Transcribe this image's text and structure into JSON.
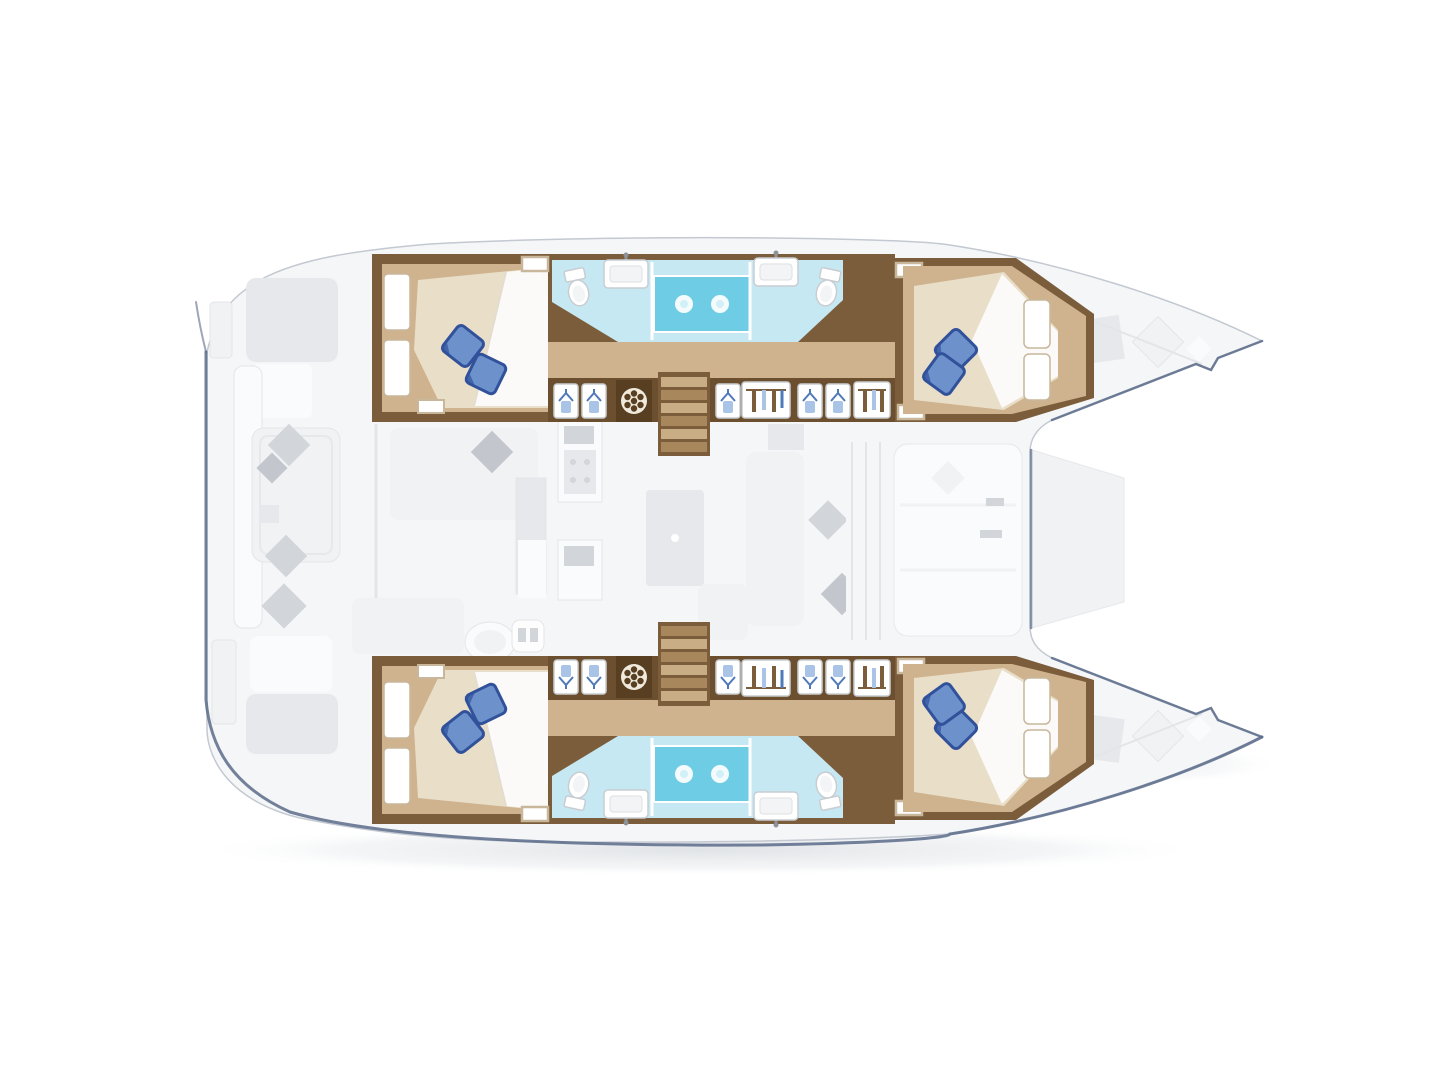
{
  "canvas": {
    "width": 1440,
    "height": 1080,
    "background": "#ffffff"
  },
  "colors": {
    "navy": "#5b6b89",
    "hull_line": "#c3c9d1",
    "deck_fill": "#f5f6f8",
    "deck_line": "#e3e5e9",
    "furn_light": "#f1f2f4",
    "furn_mid": "#e6e8eb",
    "furn_white": "#fafbfc",
    "cushion": "#d2d5da",
    "cushion_dark": "#c3c7cd",
    "wall_brown": "#7c5d3b",
    "wall_brown_deep": "#6c4f2f",
    "wall_brown_dark": "#583f22",
    "trim_tan": "#c8b79b",
    "floor_tan": "#cfb28e",
    "floor_tan_light": "#dcc9a8",
    "mattress_cream": "#e9dfc9",
    "duvet_white": "#fbfbf9",
    "pillow_blue": "#6d92cb",
    "pillow_blue_dark": "#31519b",
    "bath_floor": "#c5e8f3",
    "shower_blue": "#6ecde4",
    "shower_head_inner": "#d2f0f8",
    "fixture_line": "#c9cdd1",
    "fixture_fill": "#f2f4f5",
    "hanger_blue": "#4f79b8",
    "garment_blue": "#a9c4e6",
    "step_light": "#c9ad85",
    "step_dark": "#a8875c",
    "shadow_grey": "#dfe2e6"
  },
  "diagram": {
    "type": "catamaran-yacht-deck-plan",
    "style": "top-down-2d-floor-plan",
    "orientation": "bows-pointing-right",
    "decks": [
      {
        "name": "hull-accommodation-deck",
        "emphasis": "full-color"
      },
      {
        "name": "main-deck",
        "emphasis": "faded-grey"
      }
    ],
    "hulls": [
      {
        "name": "port-hull",
        "position": "top",
        "rooms": [
          {
            "name": "aft-double-cabin",
            "features": [
              "island-bed",
              "two-blue-pillows",
              "white-duvet",
              "hull-windows"
            ]
          },
          {
            "name": "aft-head-compartment",
            "features": [
              "toilet",
              "sink-with-faucet"
            ]
          },
          {
            "name": "central-shower",
            "features": [
              "two-shower-heads",
              "glass-partitions"
            ]
          },
          {
            "name": "forward-head-compartment",
            "features": [
              "sink-with-faucet",
              "toilet"
            ]
          },
          {
            "name": "companionway",
            "features": [
              "wardrobe-doors",
              "hanging-lockers",
              "washing-machine",
              "stairs-to-saloon",
              "deck-hatches"
            ]
          },
          {
            "name": "forward-double-cabin",
            "features": [
              "island-bed",
              "two-blue-pillows",
              "white-duvet",
              "hull-windows"
            ]
          }
        ]
      },
      {
        "name": "starboard-hull",
        "position": "bottom",
        "mirror_of": "port-hull",
        "rooms": [
          {
            "name": "aft-double-cabin",
            "features": [
              "island-bed",
              "two-blue-pillows",
              "white-duvet",
              "hull-windows"
            ]
          },
          {
            "name": "aft-head-compartment",
            "features": [
              "toilet",
              "sink-with-faucet"
            ]
          },
          {
            "name": "central-shower",
            "features": [
              "two-shower-heads",
              "glass-partitions"
            ]
          },
          {
            "name": "forward-head-compartment",
            "features": [
              "sink-with-faucet",
              "toilet"
            ]
          },
          {
            "name": "companionway",
            "features": [
              "wardrobe-doors",
              "hanging-lockers",
              "washing-machine",
              "stairs-to-saloon",
              "deck-hatches"
            ]
          },
          {
            "name": "forward-double-cabin",
            "features": [
              "island-bed",
              "two-blue-pillows",
              "white-duvet",
              "hull-windows"
            ]
          }
        ]
      }
    ],
    "main_deck_areas": [
      {
        "name": "aft-cockpit",
        "features": [
          "bench-seating",
          "cockpit-table",
          "scatter-cushions",
          "transom-steps"
        ]
      },
      {
        "name": "saloon",
        "features": [
          "galley-counter",
          "round-sink",
          "stove",
          "dinette-table",
          "sofa",
          "scatter-cushions",
          "front-windshield"
        ]
      },
      {
        "name": "forward-cockpit",
        "features": [
          "bench-seating"
        ]
      },
      {
        "name": "foredeck",
        "features": [
          "deck-hatches",
          "sun-pads",
          "bow-trampoline-gap"
        ]
      }
    ],
    "counts": {
      "cabins": 4,
      "head_compartments": 4,
      "central_showers": 2,
      "shower_heads": 4,
      "washing_machines": 2,
      "staircases": 2,
      "blue_pillows": 8
    }
  }
}
